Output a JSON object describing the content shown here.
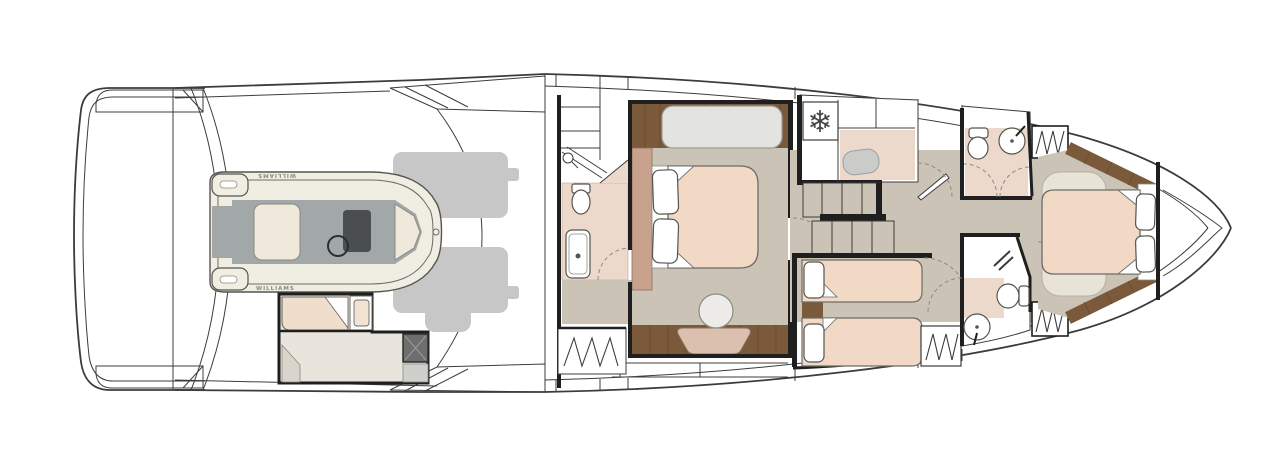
{
  "diagram": {
    "labels": {
      "tender_brand": "WILLIAMS"
    },
    "icons": {
      "freezer_snowflake": "❄"
    },
    "colors": {
      "line": "#3c3c3c",
      "wall": "#1f1f1f",
      "floor_taupe": "#cbc3b5",
      "floor_pink": "#edd9cb",
      "bed_linen": "#f1d9c6",
      "bench_pink": "#dcc0ae",
      "headboard_tan": "#c8a28c",
      "wood_floor": "#7a5a3b",
      "sofa_gray": "#e3e3e0",
      "engine_gray": "#c6c7c6",
      "tender_hull_cream": "#f0ede3",
      "tender_deck_gray": "#a2a7a7",
      "console_dark": "#4a4e50",
      "crew_floor": "#e9e5dc",
      "shower_box_dark": "#6e6e6e",
      "rug_cream": "#e8e3d7"
    }
  }
}
